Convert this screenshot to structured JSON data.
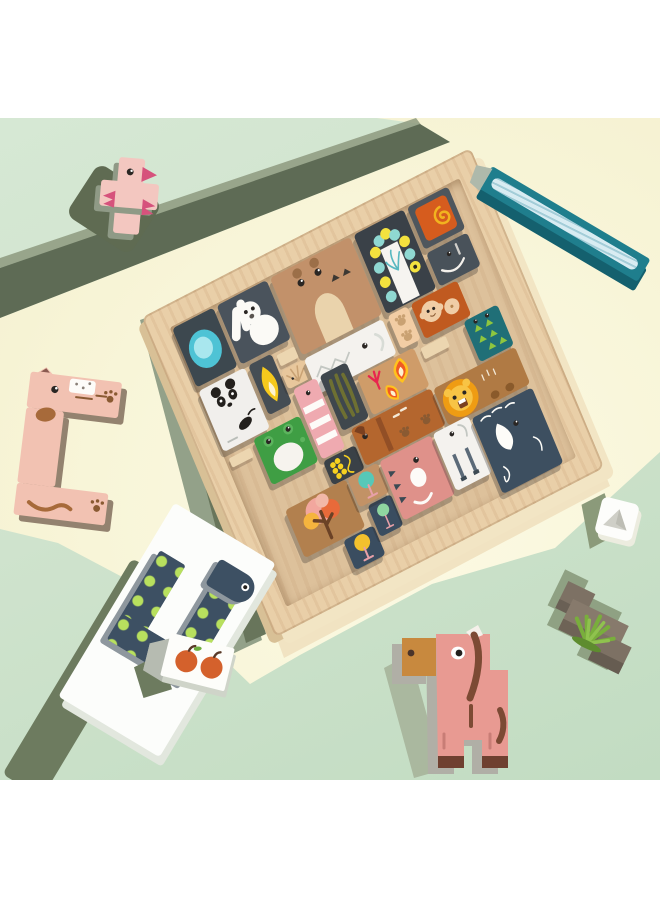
{
  "scene": {
    "description": "Product photo of a wooden tetris-style animal jigsaw puzzle board with loose blocks on a mint-green and cream backdrop",
    "colors": {
      "mint": "#cfe3cd",
      "cream": "#f8f5d8",
      "white": "#ffffff",
      "shadow_olive": "#5f6b52",
      "shadow_sage": "#93a189",
      "shadow_tray": "#6d7b5f",
      "frame_color": "#e9cfa8",
      "inner_color": "#ddc19b",
      "wall_color": "#ecd6b0"
    },
    "loose_colors": {
      "bird_pink": "#f3c7c0",
      "bird_accent": "#d6527c",
      "side_sage": "#8f9a86",
      "stick_teal": "#1f7e8d",
      "stick_dark": "#14606e",
      "stick_river": "#d8ecf2",
      "stick_cap": "#aeb9ab",
      "cat_pink": "#f2c2b2",
      "cat_side": "#93826f",
      "cat_brown": "#a76a3a",
      "tray_white": "#fcfdfb",
      "tray_side": "#e2e7de",
      "snake_navy": "#3d5063",
      "snake_lime": "#b8e05e",
      "snake_side": "#8e979e",
      "apple_red": "#d4612c",
      "horse_pink": "#e89a92",
      "horse_tan": "#c8893e",
      "horse_brown": "#7c4a34",
      "horse_gray": "#b0afa6",
      "horse_hoof": "#6f4030",
      "bush_top": "#877a6c",
      "bush_front": "#6b6054",
      "grass_green": "#79ae3c",
      "grass_light": "#8fc24e",
      "die_white": "#fdfdfb",
      "die_gray": "#cfcfc7",
      "die_shadow": "#8b9a7a"
    },
    "board": {
      "walls": [
        [
          110,
          96,
          20,
          12
        ],
        [
          246,
          156,
          28,
          12
        ],
        [
          26,
          166,
          24,
          10
        ],
        [
          130,
          216,
          16,
          16
        ]
      ],
      "pieces": [
        {
          "name": "lake",
          "x": 24,
          "y": 24,
          "w": 46,
          "h": 64,
          "color": "#3d484f",
          "motif": "blob"
        },
        {
          "name": "rabbit",
          "x": 74,
          "y": 24,
          "w": 56,
          "h": 64,
          "color": "#4a535c",
          "motif": "rabbit"
        },
        {
          "name": "bear",
          "x": 134,
          "y": 24,
          "w": 90,
          "h": 84,
          "color": "#c2916a",
          "motif": "bear"
        },
        {
          "name": "caterpillar",
          "x": 228,
          "y": 24,
          "w": 56,
          "h": 86,
          "color": "#3a4148",
          "motif": "caterpillar"
        },
        {
          "name": "snail",
          "x": 288,
          "y": 24,
          "w": 46,
          "h": 46,
          "color": "#4e565d",
          "motif": "snail"
        },
        {
          "name": "gray-elephant",
          "x": 288,
          "y": 74,
          "w": 46,
          "h": 36,
          "color": "#49525a",
          "motif": "tusk"
        },
        {
          "name": "panda",
          "x": 24,
          "y": 92,
          "w": 52,
          "h": 66,
          "color": "#f1efec",
          "motif": "panda"
        },
        {
          "name": "flame",
          "x": 80,
          "y": 92,
          "w": 26,
          "h": 54,
          "color": "#454d54",
          "motif": "flame"
        },
        {
          "name": "hedgehog",
          "x": 108,
          "y": 112,
          "w": 26,
          "h": 20,
          "color": "#e8c79c",
          "motif": "spikes"
        },
        {
          "name": "white-croc",
          "x": 134,
          "y": 112,
          "w": 88,
          "h": 38,
          "color": "#f4f2ee",
          "motif": "zigzag"
        },
        {
          "name": "paw-block",
          "x": 228,
          "y": 112,
          "w": 22,
          "h": 36,
          "color": "#f2cda4",
          "motif": "paws"
        },
        {
          "name": "monkey",
          "x": 254,
          "y": 112,
          "w": 52,
          "h": 38,
          "color": "#c05a20",
          "motif": "monkey"
        },
        {
          "name": "crocodile",
          "x": 296,
          "y": 152,
          "w": 38,
          "h": 44,
          "color": "#206f77",
          "motif": "triangles"
        },
        {
          "name": "ladder",
          "x": 112,
          "y": 134,
          "w": 26,
          "h": 76,
          "color": "#efaab0",
          "motif": "stripes"
        },
        {
          "name": "palm",
          "x": 142,
          "y": 134,
          "w": 30,
          "h": 60,
          "color": "#3f474d",
          "motif": "palm"
        },
        {
          "name": "chicken",
          "x": 176,
          "y": 152,
          "w": 64,
          "h": 42,
          "color": "#cf9c69",
          "motif": "chickenflames"
        },
        {
          "name": "frog",
          "x": 56,
          "y": 160,
          "w": 52,
          "h": 50,
          "color": "#3f9e44",
          "motif": "frogbelly"
        },
        {
          "name": "corn",
          "x": 112,
          "y": 212,
          "w": 36,
          "h": 26,
          "color": "#3a4147",
          "motif": "corn"
        },
        {
          "name": "dog",
          "x": 150,
          "y": 196,
          "w": 90,
          "h": 40,
          "color": "#b4662e",
          "motif": "dog"
        },
        {
          "name": "lion",
          "x": 242,
          "y": 198,
          "w": 92,
          "h": 40,
          "color": "#b07a44",
          "motif": "lion"
        },
        {
          "name": "trees",
          "x": 58,
          "y": 238,
          "w": 68,
          "h": 52,
          "color": "#b2804e",
          "motif": "tree"
        },
        {
          "name": "tree-navy-1",
          "x": 100,
          "y": 292,
          "w": 34,
          "h": 32,
          "color": "#3a4d60",
          "motif": "lollipop",
          "accent": "#f3c12d"
        },
        {
          "name": "tree-navy-2",
          "x": 136,
          "y": 272,
          "w": 26,
          "h": 34,
          "color": "#3a4d60",
          "motif": "lollipop",
          "accent": "#8fd6a0"
        },
        {
          "name": "tree-tan",
          "x": 128,
          "y": 238,
          "w": 34,
          "h": 32,
          "color": "#c29266",
          "motif": "lollipop",
          "accent": "#57c8b8"
        },
        {
          "name": "pink-elephant",
          "x": 164,
          "y": 238,
          "w": 58,
          "h": 64,
          "color": "#df918a",
          "motif": "pinkeleph"
        },
        {
          "name": "goat",
          "x": 224,
          "y": 238,
          "w": 40,
          "h": 62,
          "color": "#f4f2ee",
          "motif": "goatlegs"
        },
        {
          "name": "whale",
          "x": 266,
          "y": 242,
          "w": 68,
          "h": 82,
          "color": "#3d4f60",
          "motif": "whale"
        }
      ]
    }
  }
}
